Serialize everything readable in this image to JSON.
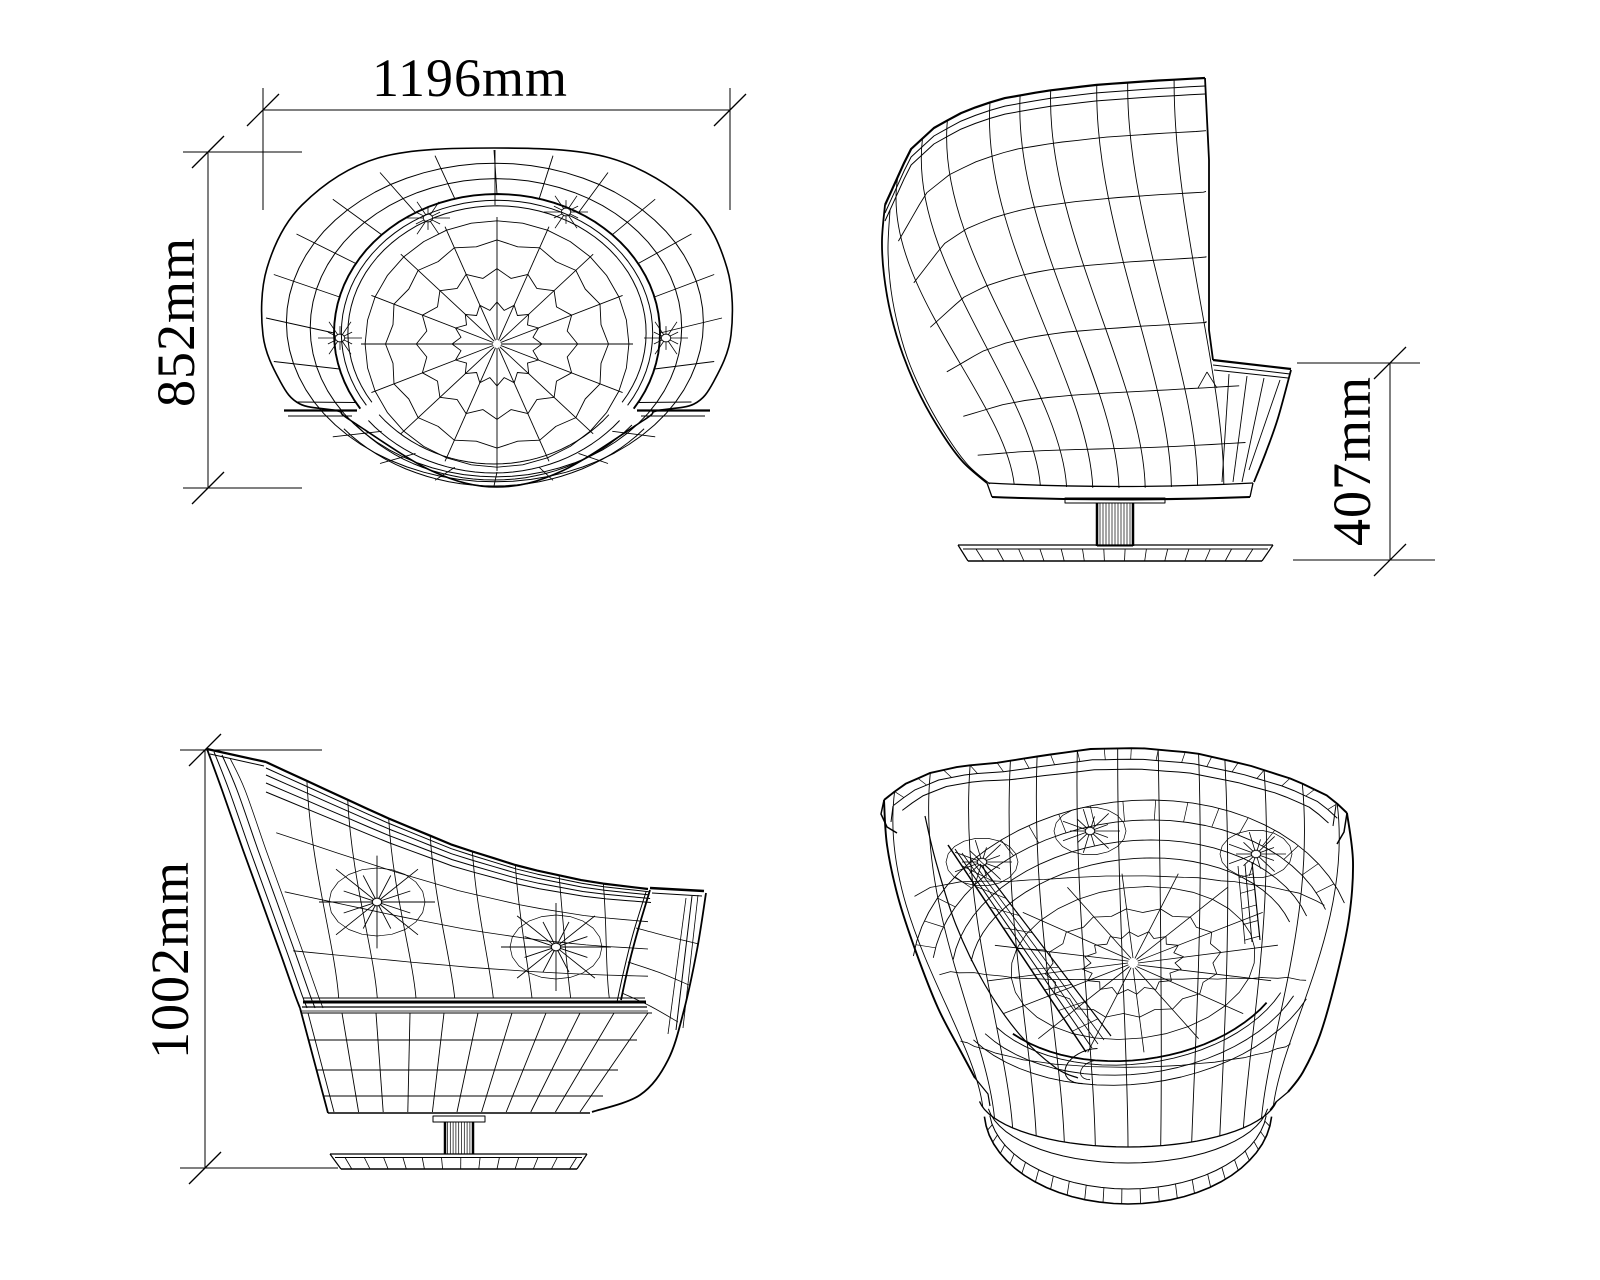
{
  "page": {
    "description": "Four-view CAD wireframe drawing of a swivel tub chair with dimension annotations",
    "background": "#ffffff",
    "ink": "#000000",
    "units": "mm"
  },
  "views": {
    "top": {
      "name": "top view",
      "width_label": "1196mm",
      "depth_label": "852mm"
    },
    "side": {
      "name": "side view",
      "seat_height_label": "407mm"
    },
    "front": {
      "name": "front view",
      "overall_height_label": "1002mm"
    },
    "perspective": {
      "name": "perspective view"
    }
  }
}
